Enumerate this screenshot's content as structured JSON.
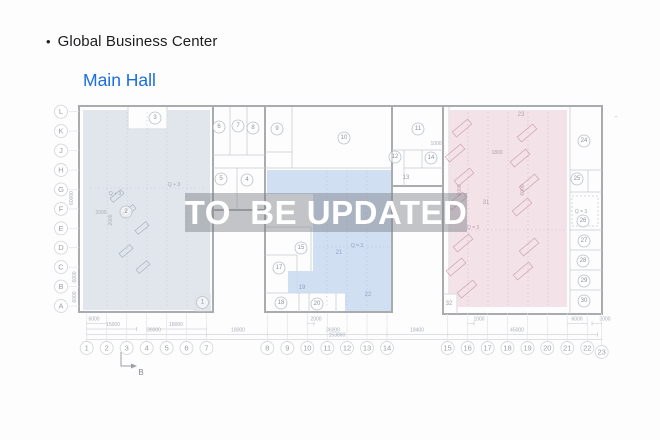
{
  "header": {
    "bullet": "•",
    "title": "Global Business Center",
    "subtitle": "Main Hall"
  },
  "watermark": {
    "text": "TO  BE UPDATED"
  },
  "colors": {
    "accent_blue": "#1a6de0",
    "zone_left": "#dde3ea",
    "zone_middle": "#ccdbf1",
    "zone_right": "#f2dfe5"
  },
  "plan": {
    "section_marker": "B",
    "grid_rows": [
      {
        "l": "L",
        "y": 111.7
      },
      {
        "l": "K",
        "y": 131.1
      },
      {
        "l": "J",
        "y": 150.6
      },
      {
        "l": "H",
        "y": 170.0
      },
      {
        "l": "G",
        "y": 189.4
      },
      {
        "l": "F",
        "y": 208.9
      },
      {
        "l": "E",
        "y": 228.3
      },
      {
        "l": "D",
        "y": 247.7
      },
      {
        "l": "C",
        "y": 267.1
      },
      {
        "l": "B",
        "y": 286.6
      },
      {
        "l": "A",
        "y": 306.0
      }
    ],
    "grid_cols": [
      {
        "l": "1",
        "x": 86.7
      },
      {
        "l": "2",
        "x": 106.7
      },
      {
        "l": "3",
        "x": 126.7
      },
      {
        "l": "4",
        "x": 146.7
      },
      {
        "l": "5",
        "x": 166.7
      },
      {
        "l": "6",
        "x": 186.5
      },
      {
        "l": "7",
        "x": 206.5
      },
      {
        "l": "8",
        "x": 267.3
      },
      {
        "l": "9",
        "x": 287.3
      },
      {
        "l": "10",
        "x": 307.3
      },
      {
        "l": "11",
        "x": 327.3
      },
      {
        "l": "12",
        "x": 347.0
      },
      {
        "l": "13",
        "x": 367.0
      },
      {
        "l": "14",
        "x": 387.0
      },
      {
        "l": "15",
        "x": 447.7
      },
      {
        "l": "16",
        "x": 467.7
      },
      {
        "l": "17",
        "x": 487.7
      },
      {
        "l": "18",
        "x": 507.5
      },
      {
        "l": "19",
        "x": 527.5
      },
      {
        "l": "20",
        "x": 547.3
      },
      {
        "l": "21",
        "x": 567.3
      },
      {
        "l": "22",
        "x": 587.3
      },
      {
        "l": "23",
        "x": 601.7,
        "cy": 352
      }
    ],
    "rooms_circled": [
      {
        "n": "1",
        "x": 202.5,
        "y": 302.5
      },
      {
        "n": "2",
        "x": 126,
        "y": 212
      },
      {
        "n": "3",
        "x": 155,
        "y": 118
      },
      {
        "n": "4",
        "x": 247,
        "y": 180
      },
      {
        "n": "5",
        "x": 221,
        "y": 179
      },
      {
        "n": "6",
        "x": 219,
        "y": 127
      },
      {
        "n": "7",
        "x": 238,
        "y": 126
      },
      {
        "n": "8",
        "x": 253,
        "y": 128
      },
      {
        "n": "9",
        "x": 277,
        "y": 129
      },
      {
        "n": "10",
        "x": 344,
        "y": 138
      },
      {
        "n": "11",
        "x": 418,
        "y": 129
      },
      {
        "n": "12",
        "x": 395,
        "y": 157
      },
      {
        "n": "14",
        "x": 431,
        "y": 158
      },
      {
        "n": "15",
        "x": 301,
        "y": 248
      },
      {
        "n": "17",
        "x": 279,
        "y": 268
      },
      {
        "n": "18",
        "x": 281,
        "y": 303
      },
      {
        "n": "20",
        "x": 317,
        "y": 304
      },
      {
        "n": "24",
        "x": 584,
        "y": 141
      },
      {
        "n": "25",
        "x": 577,
        "y": 179
      },
      {
        "n": "26",
        "x": 583,
        "y": 221
      },
      {
        "n": "27",
        "x": 584,
        "y": 241
      },
      {
        "n": "28",
        "x": 583,
        "y": 261
      },
      {
        "n": "29",
        "x": 584,
        "y": 281
      },
      {
        "n": "30",
        "x": 584,
        "y": 301
      }
    ],
    "rooms_plain": [
      {
        "n": "13",
        "x": 406,
        "y": 178,
        "c": "#9aa0a6"
      },
      {
        "n": "19",
        "x": 302,
        "y": 288,
        "c": "#93a3c4"
      },
      {
        "n": "21",
        "x": 339,
        "y": 253,
        "c": "#93a3c4"
      },
      {
        "n": "22",
        "x": 368,
        "y": 295,
        "c": "#93a3c4"
      },
      {
        "n": "23",
        "x": 521,
        "y": 115,
        "c": "#bb9daa"
      },
      {
        "n": "31",
        "x": 486,
        "y": 203,
        "c": "#bb9daa"
      },
      {
        "n": "32",
        "x": 449,
        "y": 304,
        "c": "#9aa0a6"
      }
    ],
    "annotations": [
      {
        "t": "Q + 3",
        "x": 115,
        "y": 194,
        "c": "#9fa8b2",
        "s": 5
      },
      {
        "t": "Q + 3",
        "x": 174,
        "y": 185,
        "c": "#9fa8b2",
        "s": 5
      },
      {
        "t": "Q = 3",
        "x": 357,
        "y": 246,
        "c": "#8f9fc0",
        "s": 5
      },
      {
        "t": "Q = 3",
        "x": 473,
        "y": 228,
        "c": "#bb9daa",
        "s": 5
      },
      {
        "t": "Q = 3",
        "x": 581,
        "y": 212,
        "c": "#a4a9af",
        "s": 5
      },
      {
        "t": "2000",
        "x": 101,
        "y": 213,
        "c": "#a9aeb4",
        "s": 5
      },
      {
        "t": "2000",
        "x": 111,
        "y": 220,
        "c": "#a9aeb4",
        "s": 5,
        "r": -90
      },
      {
        "t": "1800",
        "x": 497,
        "y": 153,
        "c": "#bb9daa",
        "s": 5
      },
      {
        "t": "1000",
        "x": 436,
        "y": 144,
        "c": "#a9aeb4",
        "s": 5
      },
      {
        "t": "6000",
        "x": 460,
        "y": 190,
        "c": "#bb9daa",
        "s": 5,
        "r": -90
      },
      {
        "t": "6000",
        "x": 523,
        "y": 190,
        "c": "#bb9daa",
        "s": 5,
        "r": -90
      },
      {
        "t": "60000",
        "x": 72,
        "y": 198,
        "c": "#a9aeb4",
        "s": 5,
        "r": -90
      },
      {
        "t": "6000",
        "x": 75,
        "y": 277,
        "c": "#a9aeb4",
        "s": 5,
        "r": -90
      },
      {
        "t": "6000",
        "x": 75,
        "y": 297,
        "c": "#a9aeb4",
        "s": 5,
        "r": -90
      },
      {
        "t": "–",
        "x": 616,
        "y": 117,
        "c": "#b4b7ba",
        "s": 6
      }
    ],
    "dimensions": [
      {
        "t": "6000",
        "x1": 86.7,
        "x2": 106.7,
        "tx": 94,
        "y": 319.5
      },
      {
        "t": "2000",
        "x1": 307.3,
        "x2": 314,
        "tx": 316,
        "y": 319.5
      },
      {
        "t": "1000",
        "x1": 467.7,
        "x2": 474,
        "tx": 479,
        "y": 319.5
      },
      {
        "t": "6000",
        "x1": 567.3,
        "x2": 587.3,
        "tx": 577,
        "y": 319.5
      },
      {
        "t": "3000",
        "x1": 592,
        "x2": 601.7,
        "tx": 605,
        "y": 319.5
      },
      {
        "t": "15000",
        "x1": 86.7,
        "x2": 136.7,
        "tx": 113,
        "y": 325
      },
      {
        "t": "18000",
        "x1": 146.7,
        "x2": 206.5,
        "tx": 176,
        "y": 325
      },
      {
        "t": "36000",
        "x1": 86.7,
        "x2": 206.5,
        "tx": 154,
        "y": 330.5
      },
      {
        "t": "18000",
        "x1": 206.5,
        "x2": 267.3,
        "tx": 238,
        "y": 330.5
      },
      {
        "t": "36000",
        "x1": 267.3,
        "x2": 387,
        "tx": 333,
        "y": 330.5
      },
      {
        "t": "18400",
        "x1": 387,
        "x2": 447.7,
        "tx": 417,
        "y": 330.5
      },
      {
        "t": "45000",
        "x1": 447.7,
        "x2": 597.3,
        "tx": 517,
        "y": 330.5
      },
      {
        "t": "153860",
        "x1": 86.7,
        "x2": 601.7,
        "tx": 337,
        "y": 335.5
      }
    ]
  }
}
